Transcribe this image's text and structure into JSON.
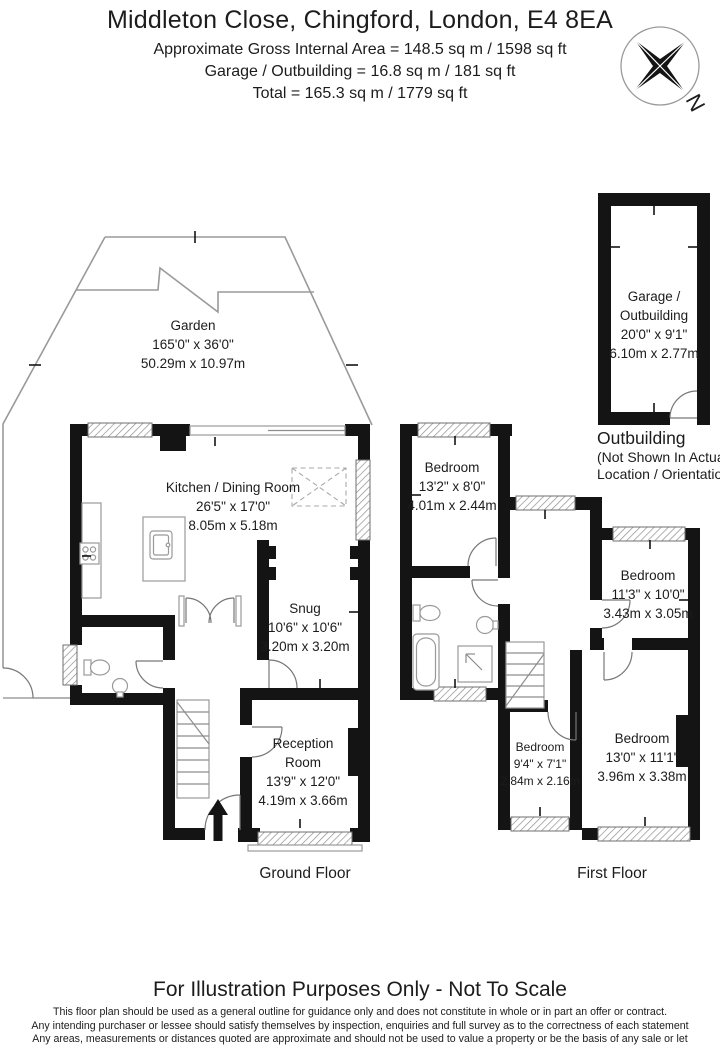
{
  "header": {
    "title": "Middleton Close, Chingford, London, E4 8EA",
    "line1": "Approximate Gross Internal Area = 148.5 sq m / 1598 sq ft",
    "line2": "Garage / Outbuilding = 16.8 sq m / 181 sq ft",
    "line3": "Total = 165.3 sq m / 1779 sq ft"
  },
  "compass": {
    "letter": "N"
  },
  "rooms": {
    "garden": {
      "name": "Garden",
      "imperial": "165'0\" x 36'0\"",
      "metric": "50.29m x 10.97m"
    },
    "kitchen": {
      "name": "Kitchen / Dining Room",
      "imperial": "26'5\" x 17'0\"",
      "metric": "8.05m x 5.18m"
    },
    "snug": {
      "name": "Snug",
      "imperial": "10'6\" x 10'6\"",
      "metric": "3.20m x 3.20m"
    },
    "reception": {
      "name1": "Reception",
      "name2": "Room",
      "imperial": "13'9\" x 12'0\"",
      "metric": "4.19m x 3.66m"
    },
    "garage": {
      "name1": "Garage /",
      "name2": "Outbuilding",
      "imperial": "20'0\" x 9'1\"",
      "metric": "6.10m x 2.77m"
    },
    "bedroom1": {
      "name": "Bedroom",
      "imperial": "13'2\" x 8'0\"",
      "metric": "4.01m x 2.44m"
    },
    "bedroom2": {
      "name": "Bedroom",
      "imperial": "11'3\" x 10'0\"",
      "metric": "3.43m x 3.05m"
    },
    "bedroom3": {
      "name": "Bedroom",
      "imperial": "13'0\" x 11'1\"",
      "metric": "3.96m x 3.38m"
    },
    "bedroom4": {
      "name": "Bedroom",
      "imperial": "9'4\" x 7'1\"",
      "metric": "2.84m x 2.16m"
    }
  },
  "labels": {
    "ground_floor": "Ground Floor",
    "first_floor": "First Floor",
    "outbuilding_title": "Outbuilding",
    "outbuilding_note1": "(Not Shown In Actual",
    "outbuilding_note2": "Location / Orientation)"
  },
  "footer": {
    "title": "For Illustration Purposes Only - Not To Scale",
    "line1": "This floor plan should be used as a general outline for guidance only and does not constitute in whole or in part an offer or contract.",
    "line2": "Any intending purchaser or lessee should satisfy themselves by inspection, enquiries and full survey as to the correctness of each statement",
    "line3": "Any areas, measurements or distances quoted are approximate and should not be used to value a property or be the basis of any sale or let"
  },
  "colors": {
    "walls": "#141414",
    "fixtures": "#999999",
    "text": "#1c1c1c"
  }
}
